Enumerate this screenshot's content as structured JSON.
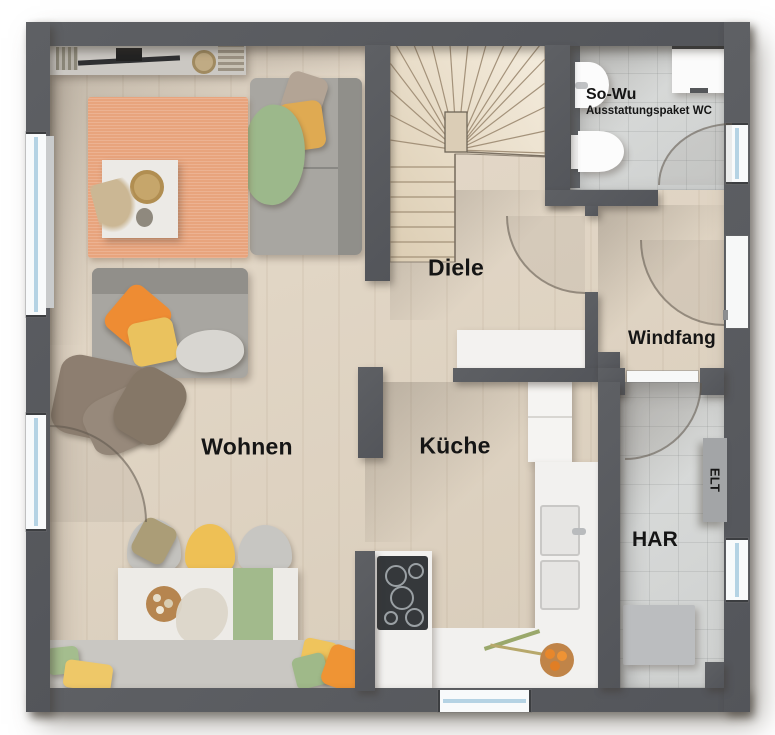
{
  "rooms": {
    "wohnen": {
      "label": "Wohnen"
    },
    "diele": {
      "label": "Diele"
    },
    "kueche": {
      "label": "Küche"
    },
    "windfang": {
      "label": "Windfang"
    },
    "har": {
      "label": "HAR"
    },
    "sowu": {
      "label": "So-Wu",
      "sublabel": "Ausstattungspaket WC"
    },
    "elt": {
      "label": "ELT"
    }
  },
  "colors": {
    "wall": "#56585b",
    "wood_floor": "#ddd2c1",
    "tile_floor": "#d6d8d7",
    "rug": "#e8a47d",
    "accent_orange": "#ee8c33",
    "accent_yellow": "#eac25e",
    "accent_green": "#9fb989",
    "window_glass": "#b5d3e4",
    "counter_white": "#f2f1ef",
    "sofa_gray": "#a8a6a1"
  },
  "features": {
    "wohnen": [
      "sideboard-shelf",
      "sofa",
      "daybed",
      "rug",
      "coffee-table",
      "dried-plant",
      "dining-table",
      "table-runner",
      "chairs",
      "bench",
      "pillows"
    ],
    "diele": [
      "sideboard",
      "winder-staircase"
    ],
    "kueche": [
      "tall-cabinet",
      "sink-counter",
      "double-sink",
      "cooktop",
      "fruit-bowl",
      "branch-decor"
    ],
    "har": [
      "elt-panel",
      "appliance-box"
    ],
    "sowu": [
      "washbasin",
      "toilet",
      "washing-machine"
    ],
    "openings": [
      "left-window",
      "terrace-door",
      "entry-door",
      "sowu-window",
      "har-window",
      "kitchen-window",
      "door-arcs"
    ]
  }
}
